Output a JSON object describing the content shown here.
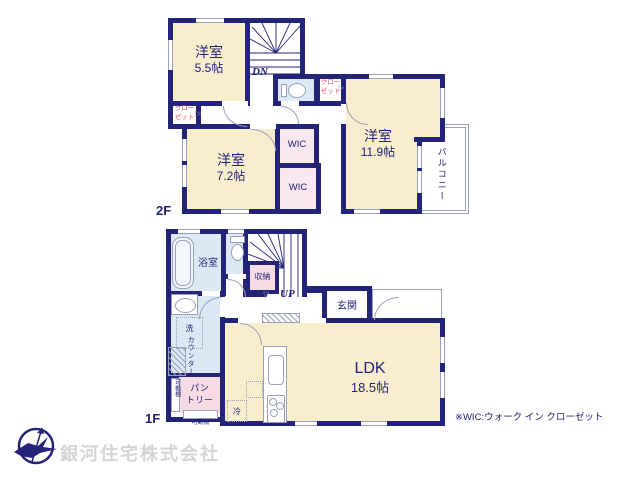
{
  "colors": {
    "wall": "#232377",
    "room_cream": "#f8edcd",
    "wet_blue": "#dce9f5",
    "pink_light": "#f9e8ef",
    "pink_deep": "#f6dbe3",
    "thin_line": "#9aa0bb",
    "closet_red": "#e25368",
    "company_gray": "#d5d5d5"
  },
  "markers": {
    "door_right": "▷",
    "door_down": "▽"
  },
  "floor2": {
    "label": "2F",
    "room_55": {
      "name": "洋室",
      "size": "5.5帖"
    },
    "room_72": {
      "name": "洋室",
      "size": "7.2帖"
    },
    "room_119": {
      "name": "洋室",
      "size": "11.9帖"
    },
    "wic_upper": "WIC",
    "wic_lower": "WIC",
    "closet_left": {
      "line1": "クロー",
      "line2": "ゼット"
    },
    "closet_right": {
      "line1": "クロー",
      "line2": "ゼット"
    },
    "stairs_down": "DN",
    "balcony": "バルコニー"
  },
  "floor1": {
    "label": "1F",
    "bathroom": "浴室",
    "storage": "収納",
    "stairs_up": "UP",
    "entrance": "玄関",
    "ldk": {
      "name": "LDK",
      "size": "18.5帖"
    },
    "pantry": {
      "line1": "パン",
      "line2": "トリー"
    },
    "shelf_side": "可動棚",
    "shelf_bottom": "可動棚",
    "counter": "カウンター",
    "laundry": "洗",
    "fridge": "冷"
  },
  "footer": {
    "note": "※WIC:ウォーク イン クローゼット",
    "company": "銀河住宅株式会社"
  }
}
